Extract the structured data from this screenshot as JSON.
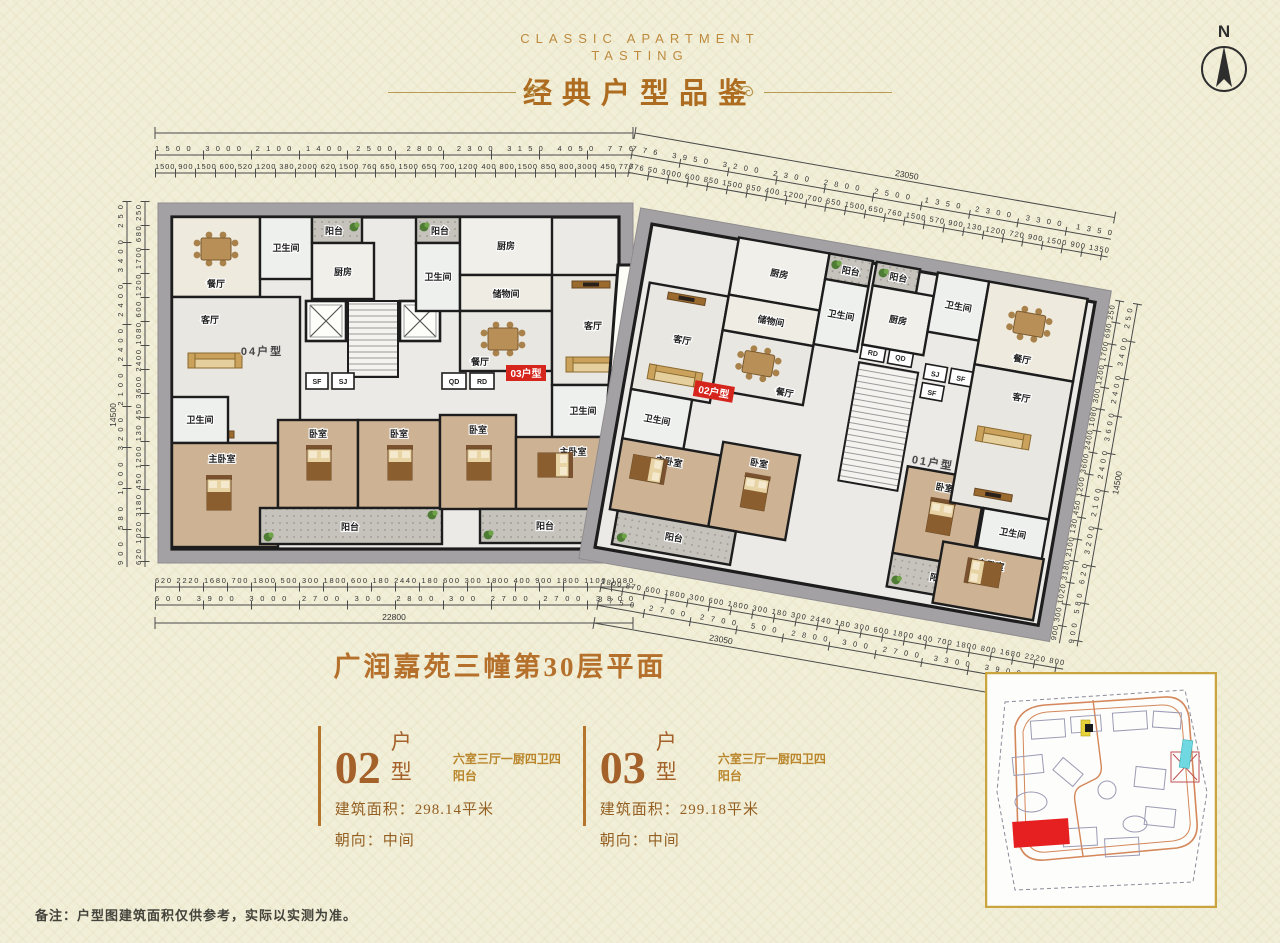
{
  "header": {
    "subtitle_line1": "CLASSIC APARTMENT",
    "subtitle_line2": "TASTING",
    "title": "经典户型品鉴",
    "compass_label": "N"
  },
  "plan": {
    "title": "广润嘉苑三幢第30层平面",
    "units": {
      "u01": "01户型",
      "u02": "02户型",
      "u03": "03户型",
      "u04": "04户型"
    },
    "rooms": {
      "living": "客厅",
      "dining": "餐厅",
      "bedroom": "卧室",
      "master_bedroom": "主卧室",
      "bathroom": "卫生间",
      "kitchen": "厨房",
      "balcony": "阳台",
      "storage": "储物间",
      "sf": "SF",
      "sj": "SJ",
      "qd": "QD",
      "rd": "RD"
    },
    "dims": {
      "top_left_row1": [
        "1500",
        "3000",
        "2100",
        "1400",
        "2500",
        "2800",
        "2300",
        "3150",
        "4050",
        "776"
      ],
      "top_left_row2": [
        "1500",
        "900",
        "1500",
        "600",
        "520",
        "1200",
        "380",
        "2000",
        "620",
        "1500",
        "760",
        "650",
        "1500",
        "650",
        "700",
        "1200",
        "400",
        "800",
        "1500",
        "850",
        "800",
        "3000",
        "450",
        "776"
      ],
      "top_right_total": "23050",
      "top_right_row1": [
        "776",
        "3950",
        "3200",
        "2300",
        "2800",
        "2500",
        "1350",
        "2300",
        "3300",
        "1350"
      ],
      "top_right_row2": [
        "776",
        "50",
        "3000",
        "600",
        "850",
        "1500",
        "850",
        "400",
        "1200",
        "700",
        "650",
        "1500",
        "650",
        "760",
        "1500",
        "570",
        "900",
        "130",
        "1200",
        "720",
        "900",
        "1500",
        "900",
        "1350"
      ],
      "bottom_left_row1": [
        "620",
        "2220",
        "1680",
        "700",
        "1800",
        "500",
        "300",
        "1800",
        "600",
        "180",
        "2440",
        "180",
        "600",
        "300",
        "1800",
        "400",
        "900",
        "1800",
        "1100",
        "1080"
      ],
      "bottom_left_row2": [
        "600",
        "3900",
        "3000",
        "2700",
        "300",
        "2800",
        "300",
        "2700",
        "2700",
        "3800"
      ],
      "bottom_left_total": "22800",
      "bottom_right_row1": [
        "1800",
        "870",
        "600",
        "1800",
        "300",
        "600",
        "1800",
        "300",
        "180",
        "300",
        "2440",
        "180",
        "300",
        "600",
        "1800",
        "400",
        "700",
        "1800",
        "800",
        "1680",
        "2220",
        "800"
      ],
      "bottom_right_row2": [
        "3750",
        "2700",
        "2700",
        "500",
        "2800",
        "300",
        "2700",
        "3300",
        "3900",
        "600"
      ],
      "bottom_right_total": "23050",
      "left_col_outer": [
        "900",
        "580",
        "1000",
        "3200",
        "2100",
        "2400",
        "2400",
        "3400",
        "250"
      ],
      "left_col_inner": [
        "620",
        "1020",
        "3180",
        "450",
        "1200",
        "130",
        "450",
        "3600",
        "2400",
        "1080",
        "600",
        "1200",
        "1700",
        "680",
        "250"
      ],
      "left_total": "14500",
      "right_col_inner": [
        "900",
        "300",
        "1020",
        "3180",
        "2100",
        "130",
        "450",
        "1200",
        "3600",
        "2400",
        "1080",
        "300",
        "1200",
        "1700",
        "690",
        "250"
      ],
      "right_col_outer": [
        "900",
        "580",
        "620",
        "3200",
        "2100",
        "2400",
        "3600",
        "2400",
        "3400",
        "250"
      ],
      "right_total": "14500"
    }
  },
  "unit_cards": [
    {
      "number": "02",
      "type_label": "户 型",
      "tagline": "六室三厅一厨四卫四阳台",
      "area_label": "建筑面积：",
      "area_value": "298.14平米",
      "facing_label": "朝向：",
      "facing_value": "中间"
    },
    {
      "number": "03",
      "type_label": "户 型",
      "tagline": "六室三厅一厨四卫四阳台",
      "area_label": "建筑面积：",
      "area_value": "299.18平米",
      "facing_label": "朝向：",
      "facing_value": "中间"
    }
  ],
  "note": "备注：户型图建筑面积仅供参考，实际以实测为准。",
  "colors": {
    "accent_gold": "#b5872f",
    "title_brown": "#b06f28",
    "highlight_red": "#d5251d",
    "wall_black": "#1d1d1d",
    "building_gray": "#a4a1a4"
  }
}
